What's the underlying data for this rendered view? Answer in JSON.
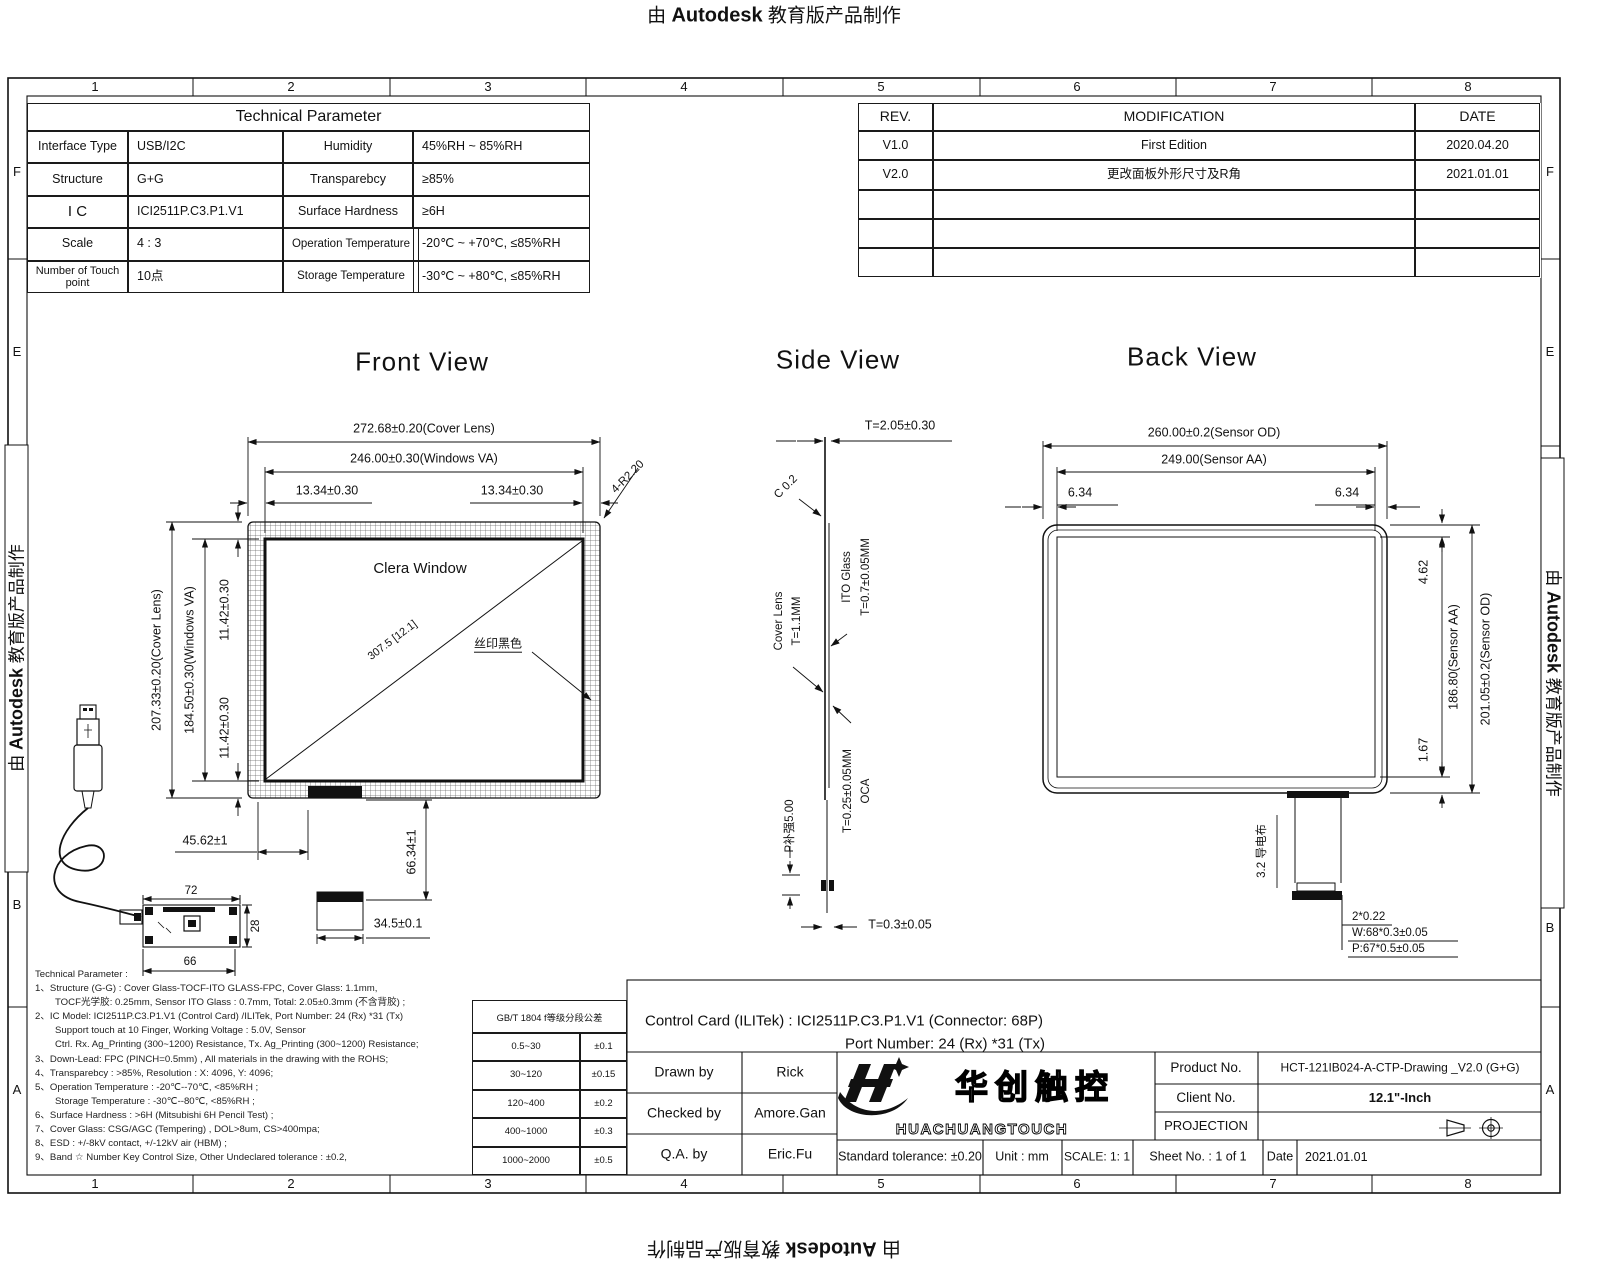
{
  "banner": {
    "prefix": "由",
    "brand": "Autodesk",
    "suffix": "教育版产品制作"
  },
  "zones": {
    "cols": [
      "1",
      "2",
      "3",
      "4",
      "5",
      "6",
      "7",
      "8"
    ],
    "rows": [
      "F",
      "E",
      "B",
      "A"
    ]
  },
  "tech_table": {
    "title": "Technical  Parameter",
    "rows": [
      [
        "Interface Type",
        "USB/I2C",
        "Humidity",
        "45%RH ~ 85%RH"
      ],
      [
        "Structure",
        "G+G",
        "Transparebcy",
        "≥85%"
      ],
      [
        "I C",
        "ICI2511P.C3.P1.V1",
        "Surface Hardness",
        "≥6H"
      ],
      [
        "Scale",
        "4 : 3",
        "Operation Temperature",
        "-20℃ ~ +70℃,  ≤85%RH"
      ],
      [
        "Number of Touch point",
        "10点",
        "Storage Temperature",
        "-30℃ ~ +80℃,  ≤85%RH"
      ]
    ]
  },
  "rev_table": {
    "headers": [
      "REV.",
      "MODIFICATION",
      "DATE"
    ],
    "rows": [
      [
        "V1.0",
        "First  Edition",
        "2020.04.20"
      ],
      [
        "V2.0",
        "更改面板外形尺寸及R角",
        "2021.01.01"
      ]
    ]
  },
  "front": {
    "title": "Front  View",
    "clear_window": "Clera  Window",
    "silk_label": "丝印黑色",
    "diagonal": "307.5 [12.1]",
    "corner_radius": "4-R2.20",
    "cover_w": "272.68±0.20(Cover Lens)",
    "va_w": "246.00±0.30(Windows VA)",
    "margin_left": "13.34±0.30",
    "margin_right": "13.34±0.30",
    "cover_h": "207.33±0.20(Cover Lens)",
    "va_h": "184.50±0.30(Windows VA)",
    "margin_top": "11.42±0.30",
    "margin_bottom": "11.42±0.30",
    "fpc_offset": "45.62±1",
    "fpc_len": "66.34±1",
    "fpc_w": "34.5±0.1",
    "pcb_w": "72",
    "pcb_h": "28",
    "pcb_w2": "66"
  },
  "side": {
    "title": "Side View",
    "total_t": "T=2.05±0.30",
    "chamfer": "C 0.2",
    "ito_l1": "ITO Glass",
    "ito_l2": "T=0.7±0.05MM",
    "cover_l1": "Cover Lens",
    "cover_l2": "T=1.1MM",
    "oca_l1": "OCA",
    "oca_l2": "T=0.25±0.05MM",
    "stiffener": "P补强5.00",
    "fpc_t": "T=0.3±0.05"
  },
  "back": {
    "title": "Back  View",
    "od_w": "260.00±0.2(Sensor OD)",
    "aa_w": "249.00(Sensor AA)",
    "margin_left": "6.34",
    "margin_right": "6.34",
    "margin_top": "4.62",
    "aa_h": "186.80(Sensor AA)",
    "od_h": "201.05±0.2(Sensor OD)",
    "margin_bottom": "1.67",
    "tail_label": "3.2 导电布",
    "tail_d1": "2*0.22",
    "tail_d2": "W:68*0.3±0.05",
    "tail_d3": "P:67*0.5±0.05"
  },
  "notes": {
    "lines": [
      "Technical  Parameter :",
      "1、Structure (G-G) : Cover Glass-TOCF-ITO GLASS-FPC, Cover Glass: 1.1mm,",
      "TOCF光学胶: 0.25mm, Sensor ITO Glass : 0.7mm, Total: 2.05±0.3mm (不含背胶) ;",
      "2、IC Model: ICI2511P.C3.P1.V1 (Control Card) /ILITek, Port Number: 24 (Rx) *31 (Tx)",
      "Support touch at 10 Finger, Working Voltage : 5.0V, Sensor",
      "Ctrl. Rx. Ag_Printing (300~1200) Resistance, Tx. Ag_Printing (300~1200) Resistance;",
      "3、Down-Lead: FPC (PINCH=0.5mm) , All materials in the drawing with the ROHS;",
      "4、Transparebcy : >85%, Resolution : X: 4096, Y: 4096;",
      "5、Operation Temperature : -20℃--70℃, <85%RH ;",
      "Storage Temperature : -30℃--80℃, <85%RH ;",
      "6、Surface Hardness : >6H (Mitsubishi 6H Pencil Test) ;",
      "7、Cover Glass: CSG/AGC (Tempering) , DOL>8um, CS>400mpa;",
      "8、ESD : +/-8kV contact, +/-12kV air (HBM) ;",
      "9、Band ☆ Number Key Control Size, Other Undeclared tolerance : ±0.2,"
    ]
  },
  "tol_table": {
    "header": "GB/T 1804 f等级分段公差",
    "rows": [
      [
        "0.5~30",
        "±0.1"
      ],
      [
        "30~120",
        "±0.15"
      ],
      [
        "120~400",
        "±0.2"
      ],
      [
        "400~1000",
        "±0.3"
      ],
      [
        "1000~2000",
        "±0.5"
      ]
    ]
  },
  "titleblock": {
    "control_line1": "Control Card (ILITek) : ICI2511P.C3.P1.V1 (Connector: 68P)",
    "control_line2": "Port Number: 24 (Rx) *31 (Tx)",
    "drawn_label": "Drawn by",
    "drawn": "Rick",
    "checked_label": "Checked by",
    "checked": "Amore.Gan",
    "qa_label": "Q.A. by",
    "qa": "Eric.Fu",
    "std_tolerance": "Standard tolerance: ±0.20",
    "unit": "Unit : mm",
    "scale": "SCALE: 1: 1",
    "sheet": "Sheet No. : 1 of 1",
    "date_label": "Date",
    "date": "2021.01.01",
    "product_label": "Product No.",
    "product": "HCT-121IB024-A-CTP-Drawing _V2.0 (G+G)",
    "client_label": "Client No.",
    "client": "12.1\"-Inch",
    "projection_label": "PROJECTION",
    "logo_cn": "华创触控",
    "logo_en": "HUACHUANGTOUCH"
  }
}
